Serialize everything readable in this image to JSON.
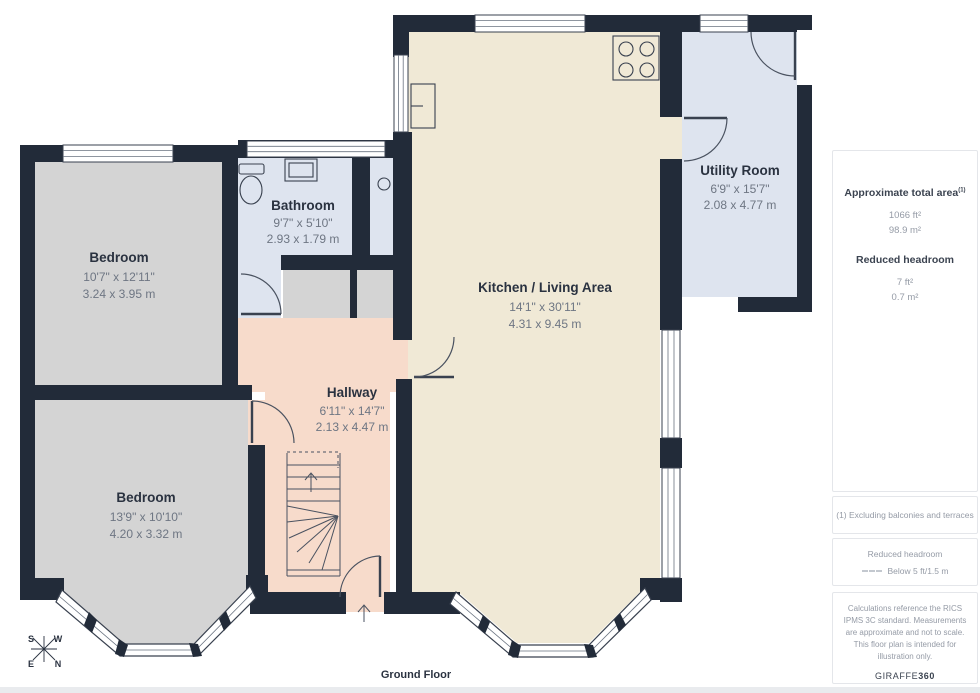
{
  "plan": {
    "floor_label": "Ground Floor",
    "rooms": [
      {
        "name": "Bedroom",
        "dim_ft": "10'7\" x 12'11\"",
        "dim_m": "3.24 x 3.95 m"
      },
      {
        "name": "Bathroom",
        "dim_ft": "9'7\" x 5'10\"",
        "dim_m": "2.93 x 1.79 m"
      },
      {
        "name": "Kitchen / Living Area",
        "dim_ft": "14'1\" x 30'11\"",
        "dim_m": "4.31 x 9.45 m"
      },
      {
        "name": "Utility Room",
        "dim_ft": "6'9\" x 15'7\"",
        "dim_m": "2.08 x 4.77 m"
      },
      {
        "name": "Hallway",
        "dim_ft": "6'11\" x 14'7\"",
        "dim_m": "2.13 x 4.47 m"
      },
      {
        "name": "Bedroom",
        "dim_ft": "13'9\" x 10'10\"",
        "dim_m": "4.20 x 3.32 m"
      }
    ],
    "compass": {
      "s": "S",
      "w": "W",
      "e": "E",
      "n": "N"
    },
    "colors": {
      "wall": "#222B39",
      "bedroom_fill": "#D4D4D4",
      "bathroom_fill": "#DEE4EF",
      "utility_fill": "#DEE4EF",
      "hallway_fill": "#F7DBCB",
      "kitchen_fill": "#F0E9D6"
    }
  },
  "sidebar": {
    "total_area": {
      "title": "Approximate total area",
      "footnote_marker": "(1)",
      "value_ft": "1066 ft²",
      "value_m": "98.9 m²"
    },
    "reduced_headroom": {
      "title": "Reduced headroom",
      "value_ft": "7 ft²",
      "value_m": "0.7 m²"
    },
    "footnote": "(1) Excluding balconies and terraces",
    "legend": {
      "title": "Reduced headroom",
      "item": "Below 5 ft/1.5 m"
    },
    "disclaimer": "Calculations reference the RICS IPMS 3C standard. Measurements are approximate and not to scale. This floor plan is intended for illustration only.",
    "brand": {
      "name": "GIRAFFE",
      "suffix": "360"
    }
  }
}
